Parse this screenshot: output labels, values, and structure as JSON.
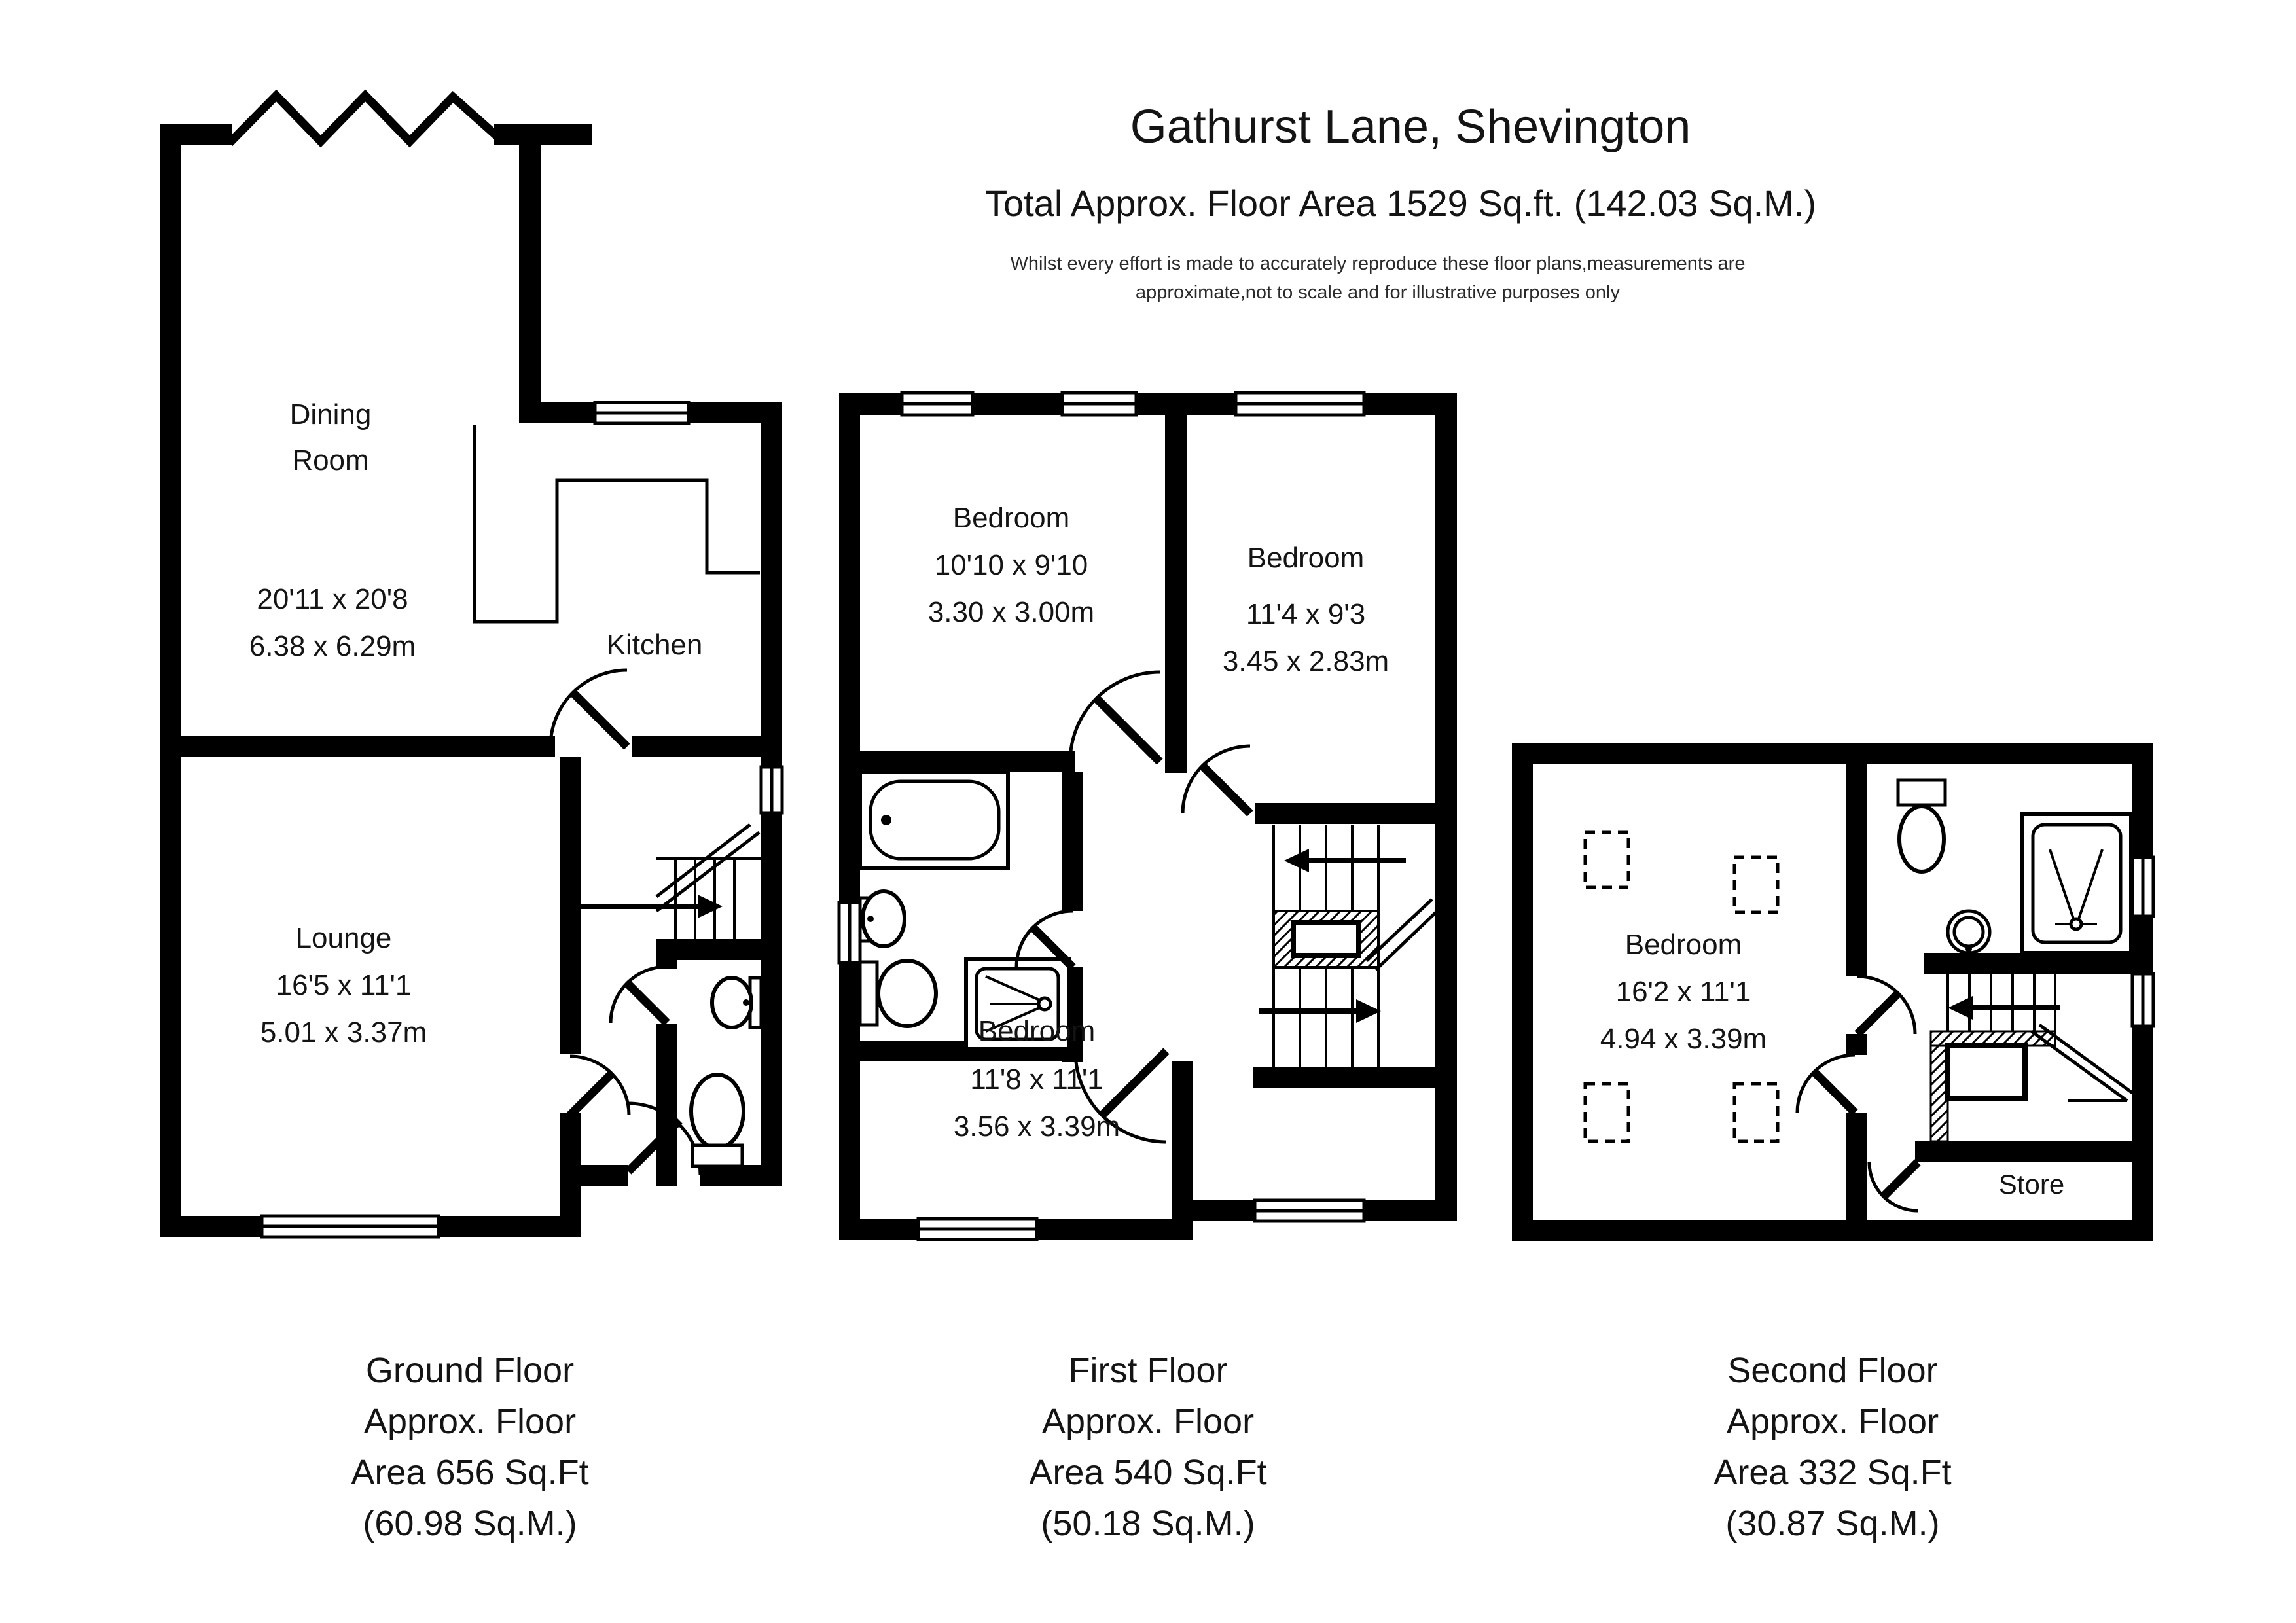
{
  "header": {
    "title": "Gathurst Lane, Shevington",
    "subtitle": "Total Approx. Floor Area 1529 Sq.ft. (142.03 Sq.M.)",
    "disclaimer_line1": "Whilst every effort is made to accurately reproduce these floor plans,measurements are",
    "disclaimer_line2": "approximate,not to scale and for illustrative purposes only"
  },
  "colors": {
    "wall": "#000000",
    "background": "#ffffff",
    "text": "#141414"
  },
  "floors": {
    "ground": {
      "rooms": {
        "dining": {
          "name_line1": "Dining",
          "name_line2": "Room",
          "dims_imperial": "20'11 x 20'8",
          "dims_metric": "6.38 x 6.29m"
        },
        "kitchen": {
          "name": "Kitchen"
        },
        "lounge": {
          "name": "Lounge",
          "dims_imperial": "16'5 x 11'1",
          "dims_metric": "5.01 x 3.37m"
        }
      },
      "label": {
        "line1": "Ground Floor",
        "line2": "Approx. Floor",
        "line3": "Area 656 Sq.Ft",
        "line4": "(60.98 Sq.M.)"
      }
    },
    "first": {
      "rooms": {
        "bedroom_front_left": {
          "name": "Bedroom",
          "dims_imperial": "10'10 x 9'10",
          "dims_metric": "3.30 x 3.00m"
        },
        "bedroom_front_right": {
          "name": "Bedroom",
          "dims_imperial": "11'4 x 9'3",
          "dims_metric": "3.45 x 2.83m"
        },
        "bedroom_rear": {
          "name": "Bedroom",
          "dims_imperial": "11'8 x 11'1",
          "dims_metric": "3.56 x 3.39m"
        }
      },
      "label": {
        "line1": "First Floor",
        "line2": "Approx. Floor",
        "line3": "Area 540 Sq.Ft",
        "line4": "(50.18 Sq.M.)"
      }
    },
    "second": {
      "rooms": {
        "bedroom": {
          "name": "Bedroom",
          "dims_imperial": "16'2 x 11'1",
          "dims_metric": "4.94 x 3.39m"
        },
        "store": {
          "name": "Store"
        }
      },
      "label": {
        "line1": "Second Floor",
        "line2": "Approx. Floor",
        "line3": "Area 332 Sq.Ft",
        "line4": "(30.87 Sq.M.)"
      }
    }
  }
}
